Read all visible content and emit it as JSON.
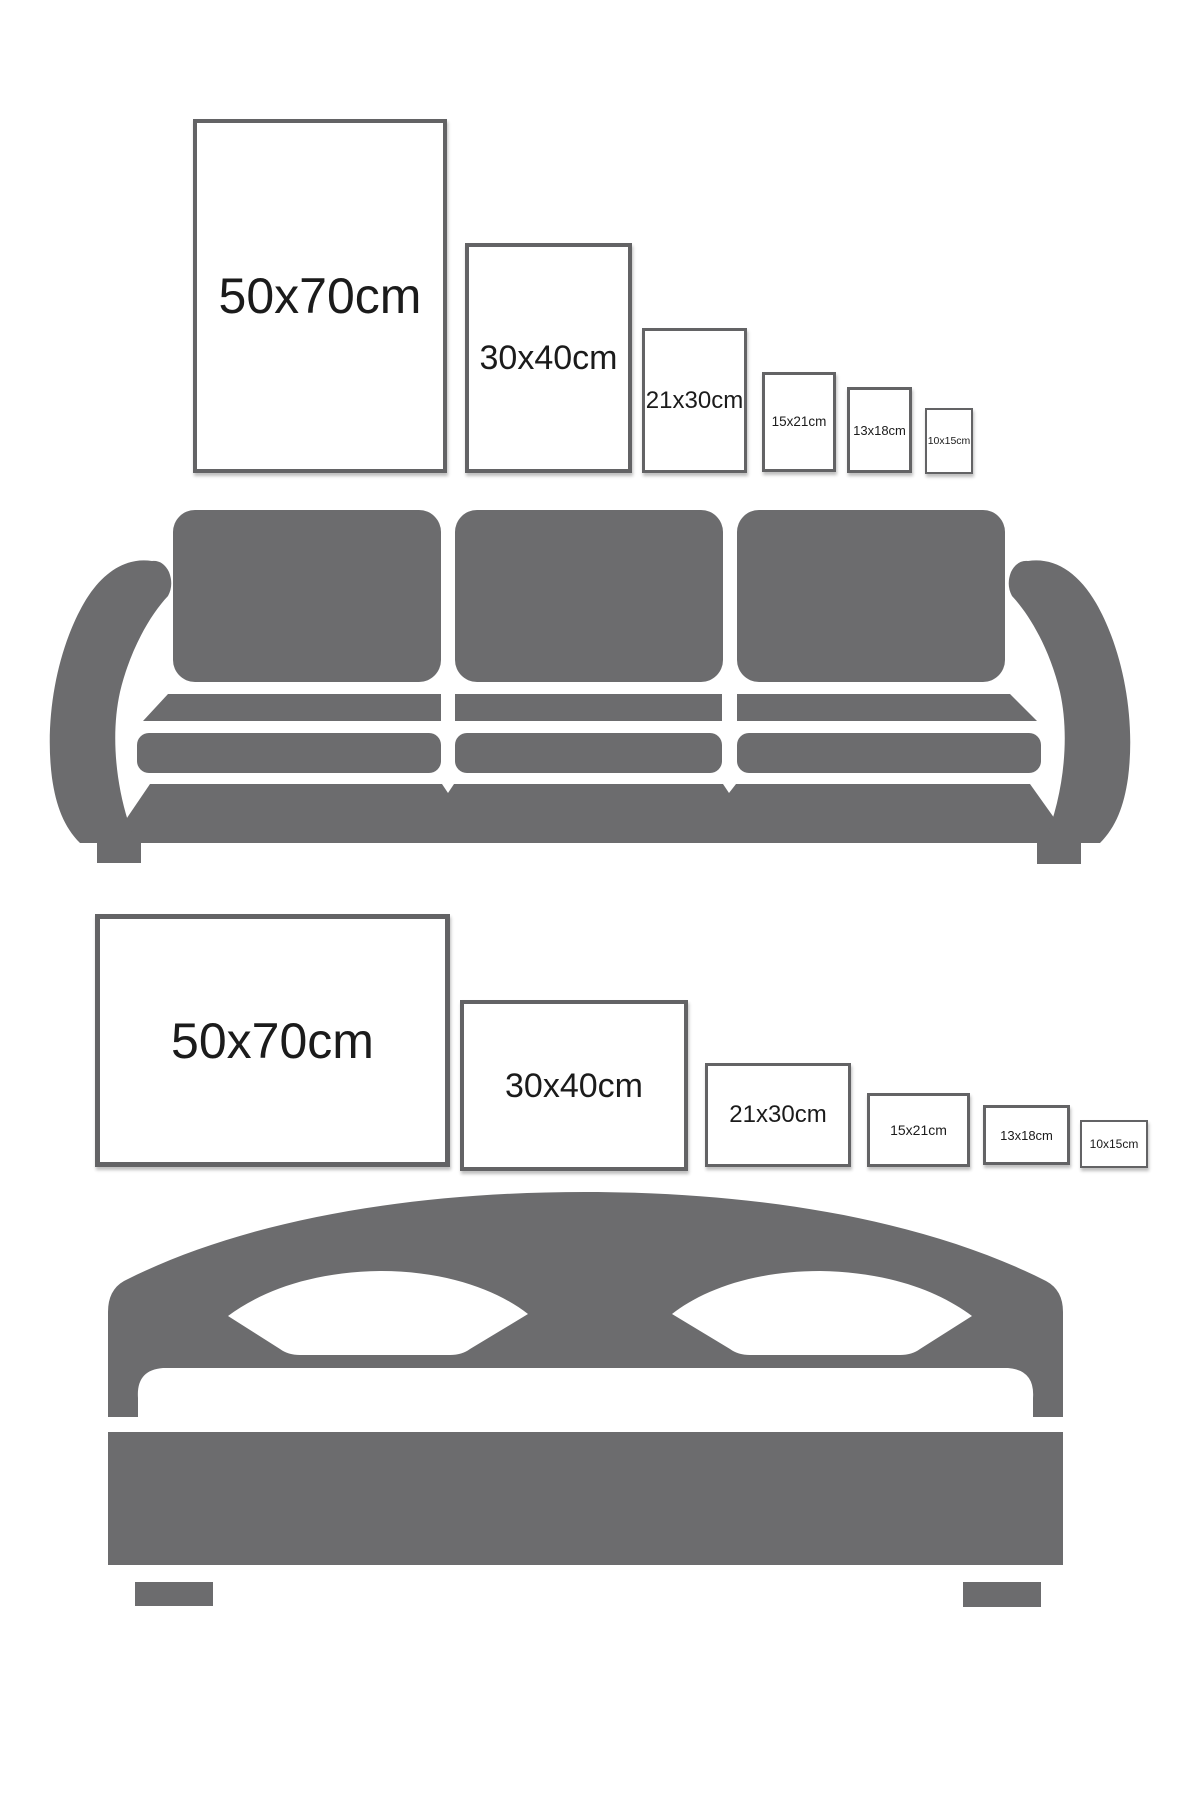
{
  "colors": {
    "furniture_gray": "#6c6c6e",
    "frame_border": "#636365",
    "label_text": "#1b1b1b",
    "background": "#ffffff"
  },
  "rows": [
    {
      "orientation": "portrait",
      "frames": [
        {
          "label": "50x70cm"
        },
        {
          "label": "30x40cm"
        },
        {
          "label": "21x30cm"
        },
        {
          "label": "15x21cm"
        },
        {
          "label": "13x18cm"
        },
        {
          "label": "10x15cm"
        }
      ]
    },
    {
      "orientation": "landscape",
      "frames": [
        {
          "label": "50x70cm"
        },
        {
          "label": "30x40cm"
        },
        {
          "label": "21x30cm"
        },
        {
          "label": "15x21cm"
        },
        {
          "label": "13x18cm"
        },
        {
          "label": "10x15cm"
        }
      ]
    }
  ],
  "illustrations": [
    {
      "type": "sofa"
    },
    {
      "type": "bed"
    }
  ]
}
